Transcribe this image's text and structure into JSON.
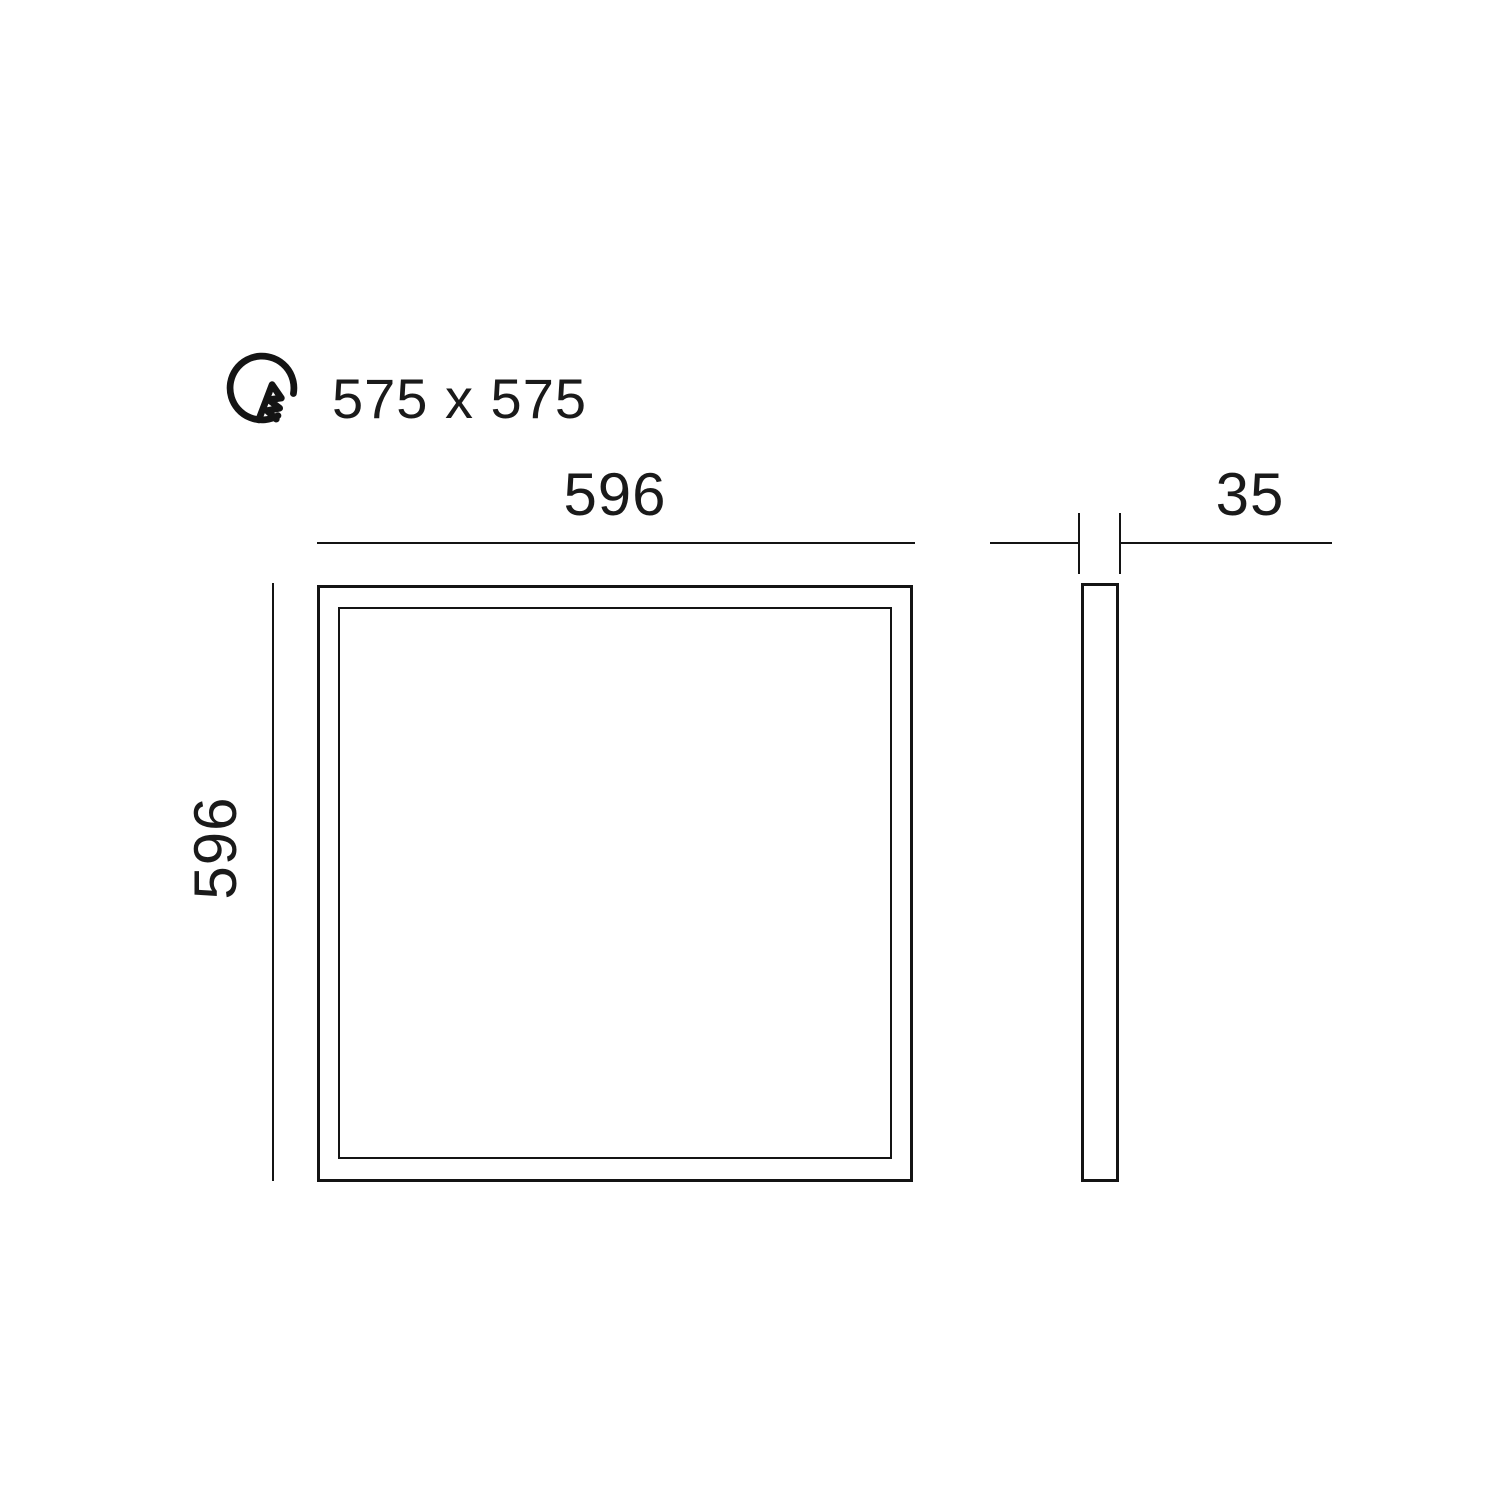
{
  "drawing": {
    "type": "technical-dimension-diagram",
    "subject": "square recessed LED panel light",
    "cutout": {
      "icon": "cutout-circle-icon",
      "label": "575 x 575"
    },
    "front_view": {
      "width_label": "596",
      "height_label": "596"
    },
    "side_view": {
      "thickness_label": "35"
    },
    "colors": {
      "line": "#141414",
      "text": "#1a1a1a",
      "watermark": "#e7e7e7",
      "background": "#ffffff"
    }
  },
  "watermark": {
    "text": "alasans.rs"
  }
}
